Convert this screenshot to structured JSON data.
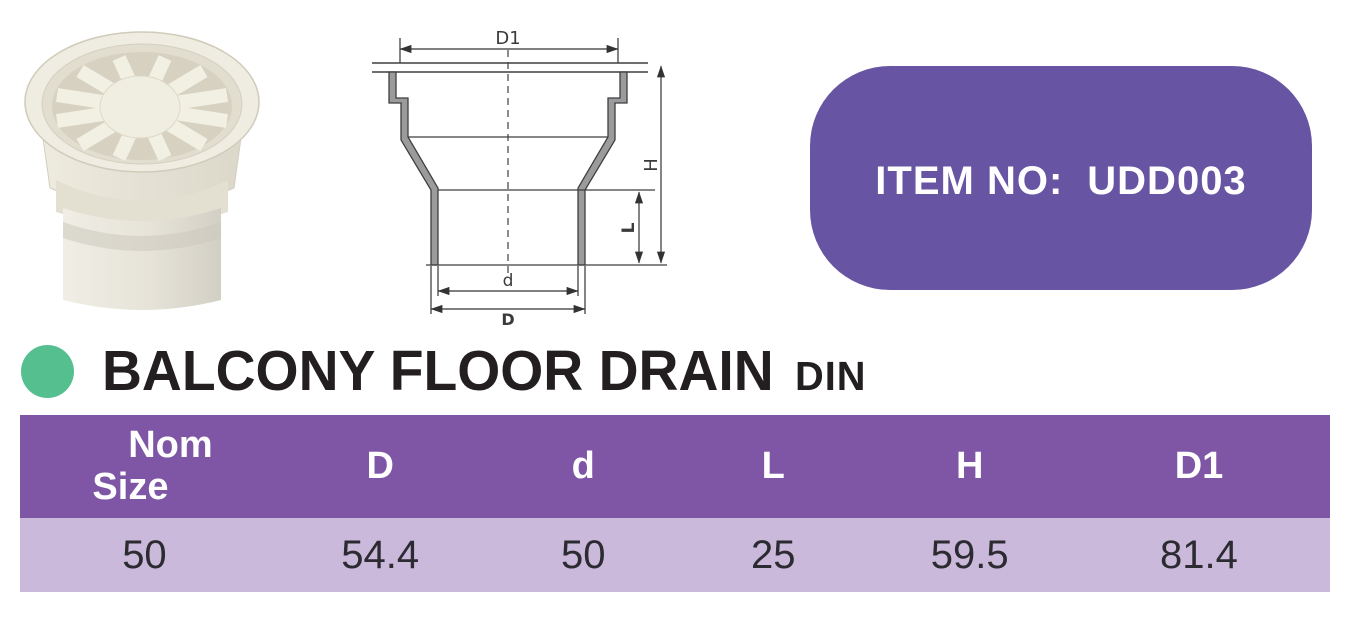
{
  "badge": {
    "label": "ITEM NO:",
    "value": "UDD003"
  },
  "title": {
    "text": "BALCONY FLOOR DRAIN",
    "standard": "DIN"
  },
  "diagram_labels": {
    "d1": "D1",
    "h": "H",
    "l": "L",
    "d_inner": "d",
    "d_outer": "D"
  },
  "table": {
    "header": {
      "col1_line1": "Nom",
      "col1_line2": "Size",
      "col2": "D",
      "col3": "d",
      "col4": "L",
      "col5": "H",
      "col6": "D1"
    },
    "rows": [
      {
        "nom_size": "50",
        "d_outer": "54.4",
        "d_inner": "50",
        "l": "25",
        "h": "59.5",
        "d1": "81.4"
      }
    ]
  },
  "colors": {
    "badge-purple": "#6754a3",
    "header-purple": "#7e56a5",
    "row-lavender": "#cbb9dc",
    "accent-green": "#55bf90",
    "title-black": "#231f20"
  }
}
